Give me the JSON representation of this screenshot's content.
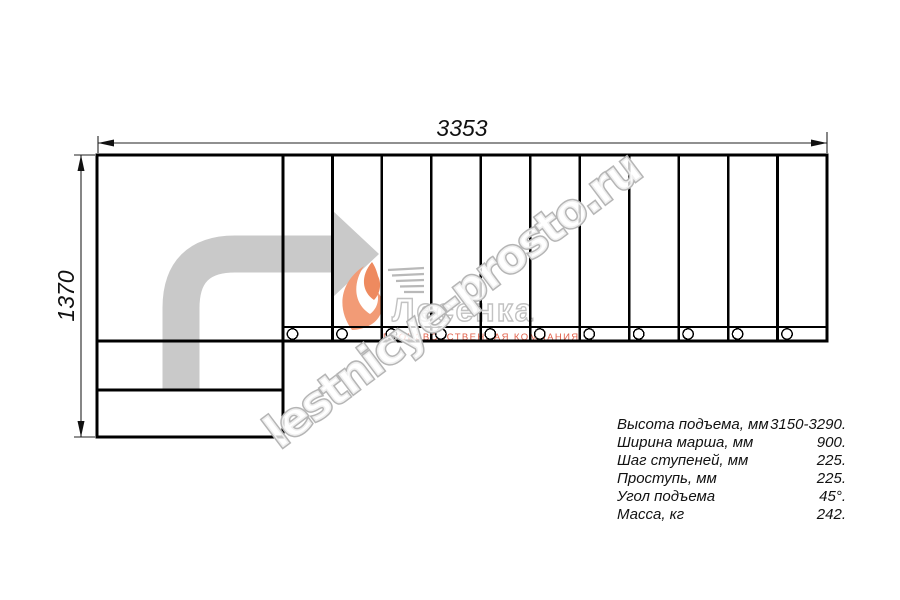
{
  "diagram": {
    "width_label": "3353",
    "height_label": "1370",
    "step_count": 11,
    "fastener_count": 11
  },
  "watermark": {
    "text": "lestnicye-prosto.ru",
    "outline_color": "#b5b5b5"
  },
  "logo": {
    "brand": "Лесенка",
    "subtitle": "ПРОИЗВОДСТВЕННАЯ КОМПАНИЯ",
    "accent_color": "#f29b76",
    "subtitle_color": "#e2604a"
  },
  "colors": {
    "line": "#000000",
    "arrow": "#c9c9c9"
  },
  "specs": {
    "rows": [
      {
        "label": "Высота подъема, мм",
        "value": "3150-3290."
      },
      {
        "label": "Ширина марша, мм",
        "value": "900."
      },
      {
        "label": "Шаг ступеней, мм",
        "value": "225."
      },
      {
        "label": "Проступь, мм",
        "value": "225."
      },
      {
        "label": "Угол подъема",
        "value": "45°."
      },
      {
        "label": "Масса, кг",
        "value": "242."
      }
    ]
  }
}
